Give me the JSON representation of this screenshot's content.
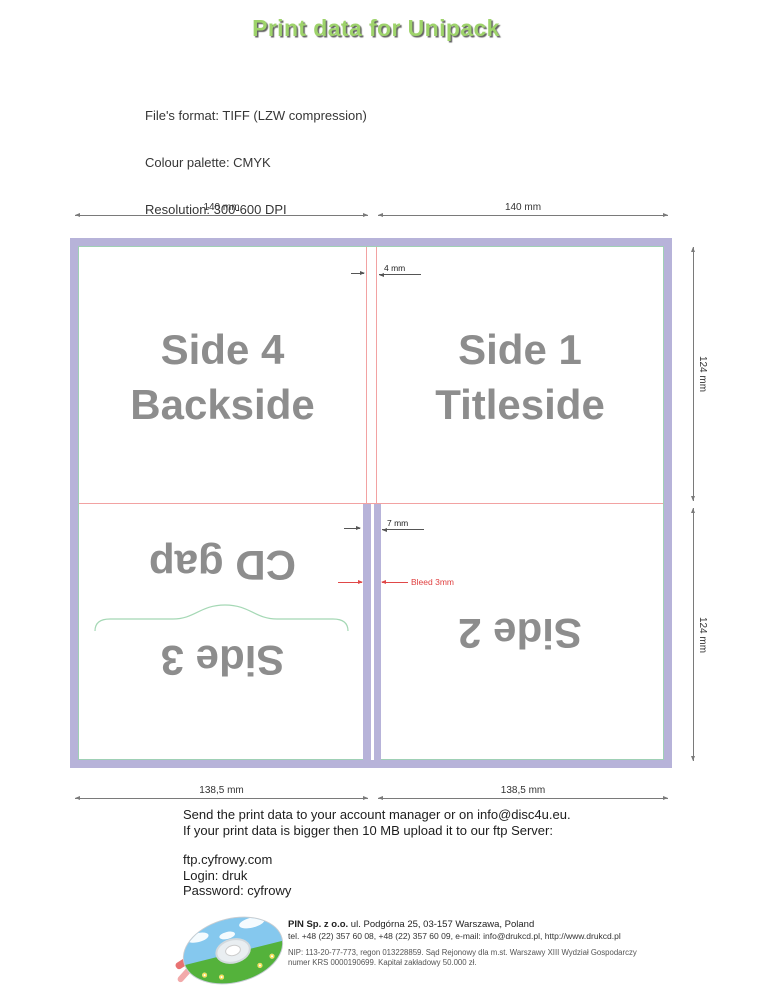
{
  "title": "Print data for Unipack",
  "specs": [
    "File's format: TIFF (LZW compression)",
    "Colour palette: CMYK",
    "Resolution: 300-600 DPI",
    "Print area: 284  mm x 248mm, a bleed ( 3 mm ) is indispensable.",
    "Project area with the bleeds: 290 mm x 254 mm.",
    "On the bleeds should be no text or pictures to avoid cutting them."
  ],
  "diagram": {
    "dim_top_left": "140 mm",
    "dim_top_right": "140 mm",
    "dim_right_top": "124 mm",
    "dim_right_bottom": "124 mm",
    "dim_bottom_left": "138,5 mm",
    "dim_bottom_right": "138,5 mm",
    "gap_top_label": "4 mm",
    "gap_bottom_label": "7 mm",
    "bleed_label": "Bleed 3mm",
    "side4_line1": "Side 4",
    "side4_line2": "Backside",
    "side1_line1": "Side 1",
    "side1_line2": "Titleside",
    "cd_gap_label": "CD gap",
    "side3_label": "Side 3",
    "side2_label": "Side 2",
    "colors": {
      "frame": "#b7b3d9",
      "cut_line": "#9fd0b5",
      "fold_guide": "#f2a2a2",
      "bleed_accent": "#e04040",
      "panel_text": "#8d8d8d",
      "title_green": "#9ed36b"
    }
  },
  "instructions": [
    "Send the print data to your account manager or on info@disc4u.eu.",
    "If your print data is bigger then 10 MB upload it to our ftp Server:"
  ],
  "ftp": [
    "ftp.cyfrowy.com",
    "Login: druk",
    "Password: cyfrowy"
  ],
  "company": {
    "name": "PIN Sp. z o.o.",
    "address": " ul. Podgórna 25, 03-157 Warszawa, Poland",
    "contact": "tel. +48 (22) 357 60 08, +48 (22) 357 60 09, e-mail: info@drukcd.pl, http://www.drukcd.pl",
    "registry1": "NIP: 113-20-77-773, regon 013228859. Sąd Rejonowy dla m.st. Warszawy XIII Wydział Gospodarczy",
    "registry2": "numer KRS 0000190699. Kapitał zakładowy 50.000 zł."
  }
}
